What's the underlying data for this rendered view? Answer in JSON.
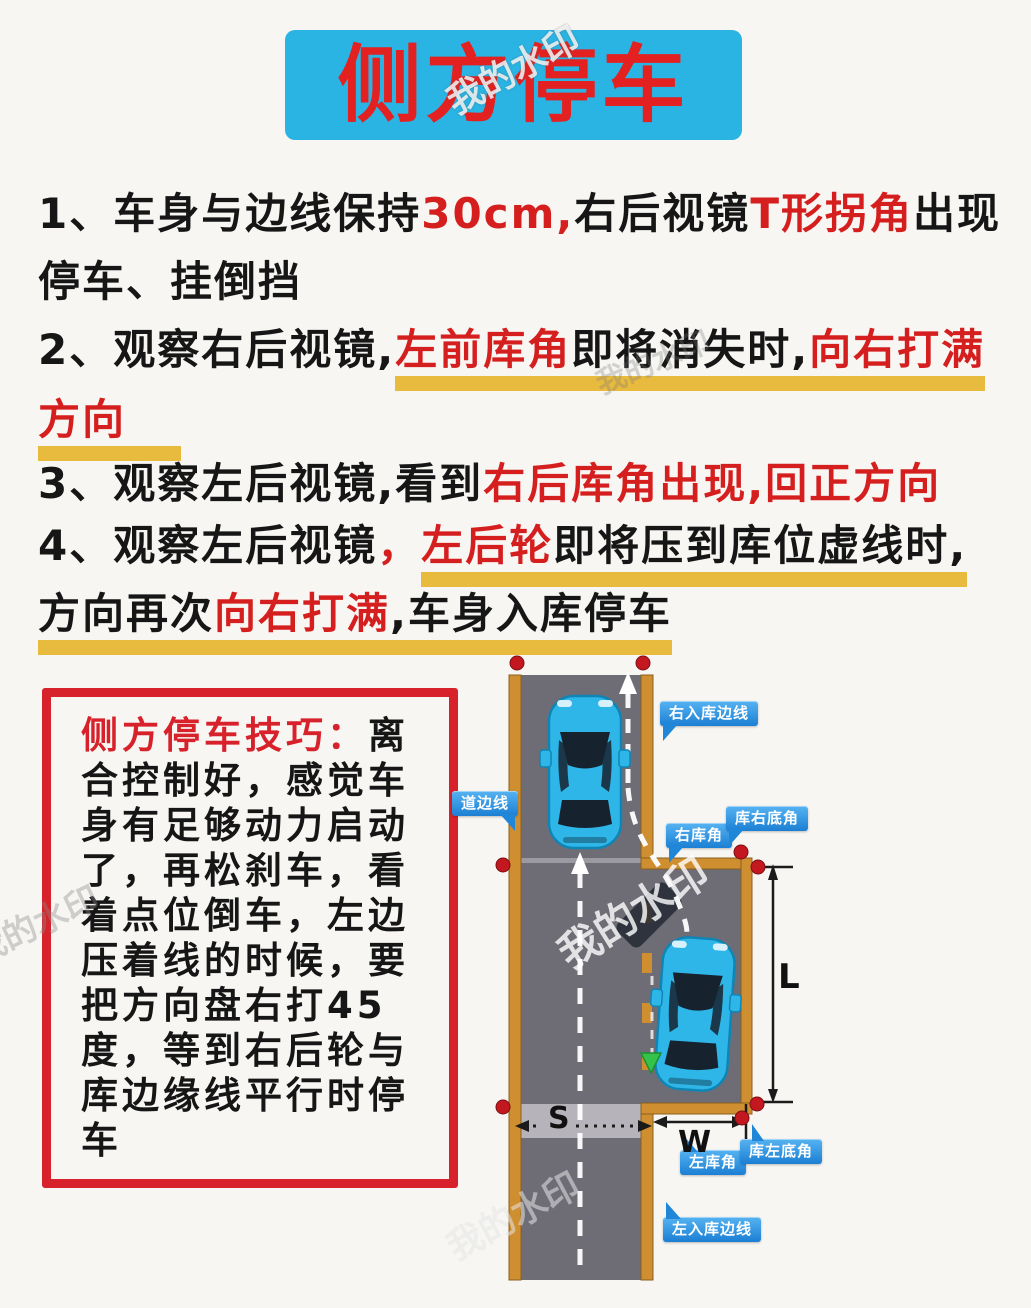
{
  "title": {
    "text": "侧方停车"
  },
  "watermark": {
    "text": "我的水印"
  },
  "steps": [
    {
      "segments": [
        {
          "text": "1、车身与边线保持",
          "color": "dark"
        },
        {
          "text": "30cm,",
          "color": "red"
        },
        {
          "text": "右后视镜",
          "color": "dark"
        },
        {
          "text": "T形拐角",
          "color": "red"
        },
        {
          "text": "出现",
          "color": "dark"
        }
      ]
    },
    {
      "segments": [
        {
          "text": "停车、挂倒挡",
          "color": "dark"
        }
      ]
    },
    {
      "segments": [
        {
          "text": "2、观察右后视镜,",
          "color": "dark"
        },
        {
          "text": "左前库角",
          "color": "red"
        },
        {
          "text": "即将消失时,",
          "color": "dark"
        },
        {
          "text": "向右打满",
          "color": "red"
        }
      ]
    },
    {
      "segments": [
        {
          "text": "方向",
          "color": "red"
        }
      ]
    },
    {
      "segments": [
        {
          "text": "3、观察左后视镜,看到",
          "color": "dark"
        },
        {
          "text": "右后库角出现,回正方向",
          "color": "red"
        }
      ]
    },
    {
      "segments": [
        {
          "text": "4、观察左后视镜",
          "color": "dark"
        },
        {
          "text": "，",
          "color": "red"
        },
        {
          "text": "左后轮",
          "color": "red"
        },
        {
          "text": "即将压到库位虚线时,",
          "color": "dark"
        }
      ]
    },
    {
      "segments": [
        {
          "text": "方向再次",
          "color": "dark"
        },
        {
          "text": "向右打满",
          "color": "red"
        },
        {
          "text": ",车身入库停车",
          "color": "dark"
        }
      ]
    }
  ],
  "tips": {
    "heading": "侧方停车技巧：",
    "body": "离合控制好，感觉车身有足够动力启动了，再松刹车，看着点位倒车，左边压着线的时候，要把方向盘右打45度，等到右后轮与库边缘线平行时停车"
  },
  "diagram": {
    "callouts": {
      "road_edge": "道边线",
      "right_entry_edge": "右入库边线",
      "right_corner": "右库角",
      "right_bottom_corner": "库右底角",
      "left_corner": "左库角",
      "left_bottom_corner": "库左底角",
      "left_entry_edge": "左入库边线"
    },
    "dims": {
      "length": "L",
      "width": "W",
      "road_width": "S"
    },
    "colors": {
      "road": "#6e6c75",
      "lane_line": "#cf8f30",
      "car": "#2eb6e8",
      "car_window": "#16222e",
      "callout": "#1f86d8",
      "dot": "#c41820",
      "marker_green": "#35c24b",
      "path_white": "#ffffff",
      "dim_black": "#1b1b1b"
    }
  },
  "theme": {
    "page_bg": "#f7f6f3",
    "title_bg": "#29b4e3",
    "title_color": "#e32121",
    "accent_red": "#d51f1f",
    "underline_yellow": "#e8ba3e",
    "tips_border": "#d8222b",
    "text_dark": "#161616"
  }
}
